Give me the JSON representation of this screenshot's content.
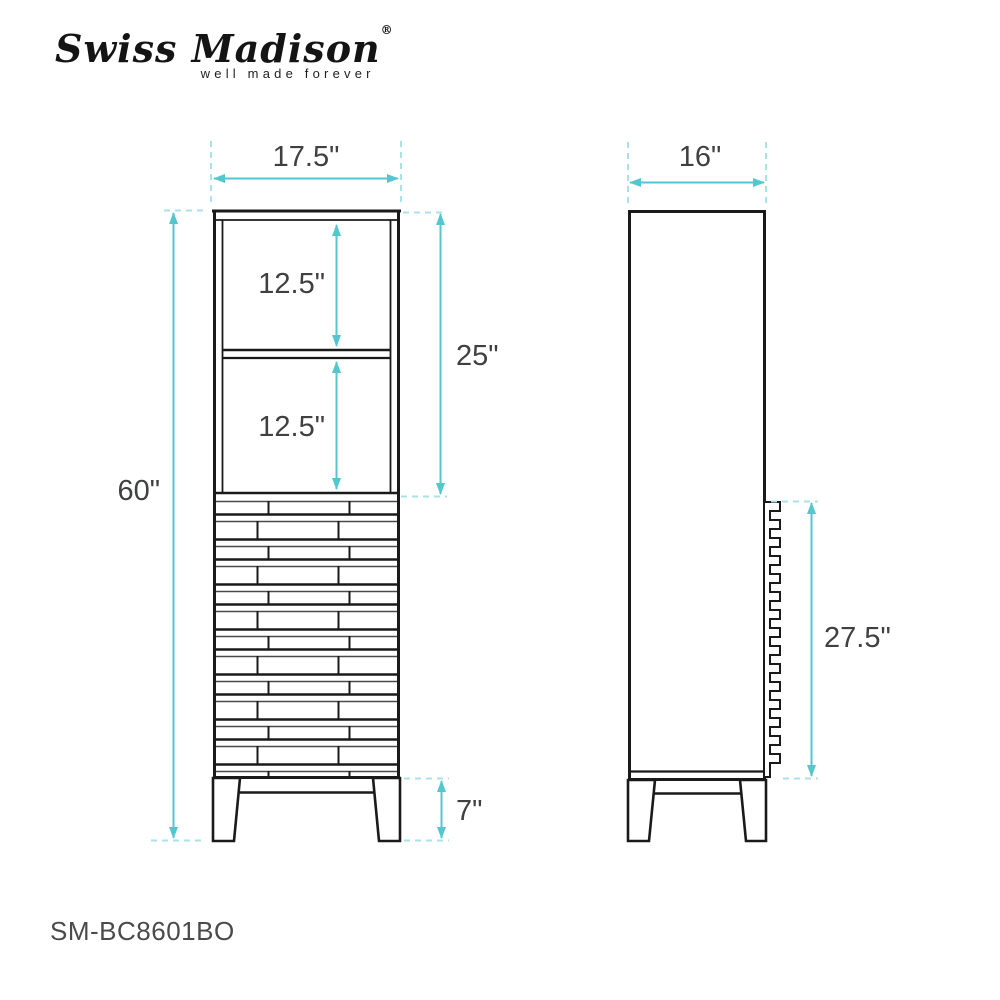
{
  "brand": {
    "name": "Swiss Madison",
    "registered": "®",
    "tagline": "well made forever"
  },
  "product": {
    "sku": "SM-BC8601BO"
  },
  "dimensions": {
    "front_width": "17.5\"",
    "front_height": "60\"",
    "upper_section": "25\"",
    "shelf_top": "12.5\"",
    "shelf_bottom": "12.5\"",
    "leg_height": "7\"",
    "side_depth": "16\"",
    "drawer_section": "27.5\""
  },
  "colors": {
    "accent": "#53C6CF",
    "accent_light": "#A9E2E8",
    "ink": "#1A1A1A",
    "label": "#3F4040"
  }
}
